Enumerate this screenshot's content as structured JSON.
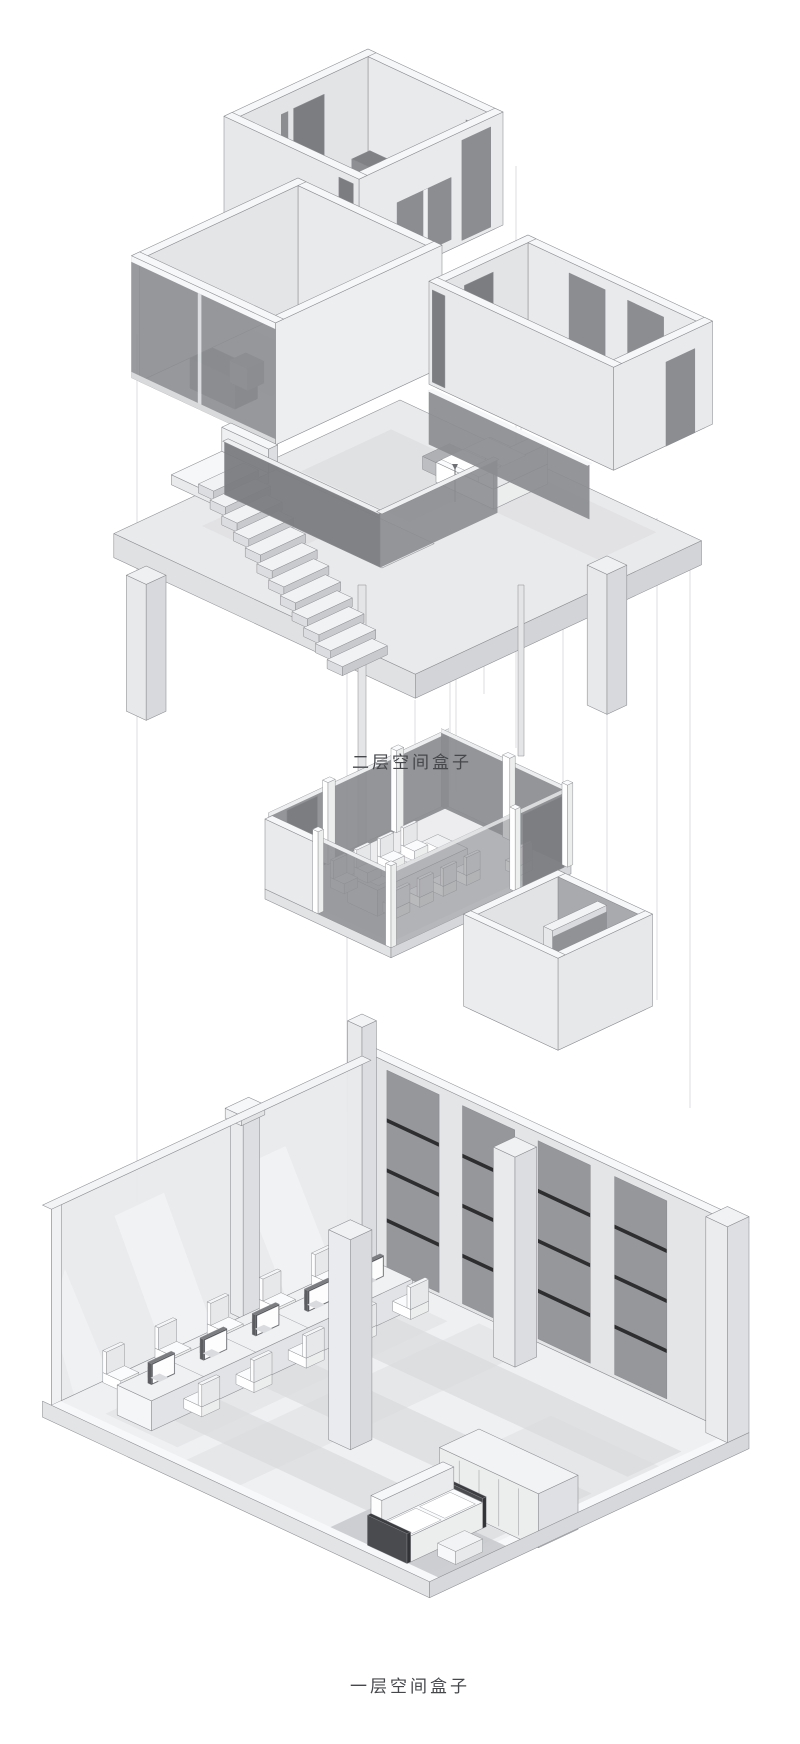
{
  "diagram": {
    "type": "axonometric-exploded-interior",
    "labels": {
      "second_floor": "二层空间盒子",
      "first_floor": "一层空间盒子"
    }
  },
  "palette": {
    "background": "#ffffff",
    "line": "#8a8c90",
    "wall_light": "#e9eaec",
    "wall_soft": "#e3e4e6",
    "wall_mid": "#dddee1",
    "wall_shade": "#cfd0d3",
    "wall_dark": "#a8aaae",
    "rim_white": "#f6f7f8",
    "floor": "#eff0f2",
    "floor_shadow": "#d9dadd",
    "glass_dark": "#8b8d91",
    "glass_darker": "#7b7d81",
    "panel_mid": "#95979b",
    "panel_bar": "#2e2e30",
    "furn_white": "#fafbfc",
    "furn_dark": "#7f8184",
    "rug": "#c9cacd",
    "projection": "#d2d3d6",
    "label_color": "#45474b"
  }
}
